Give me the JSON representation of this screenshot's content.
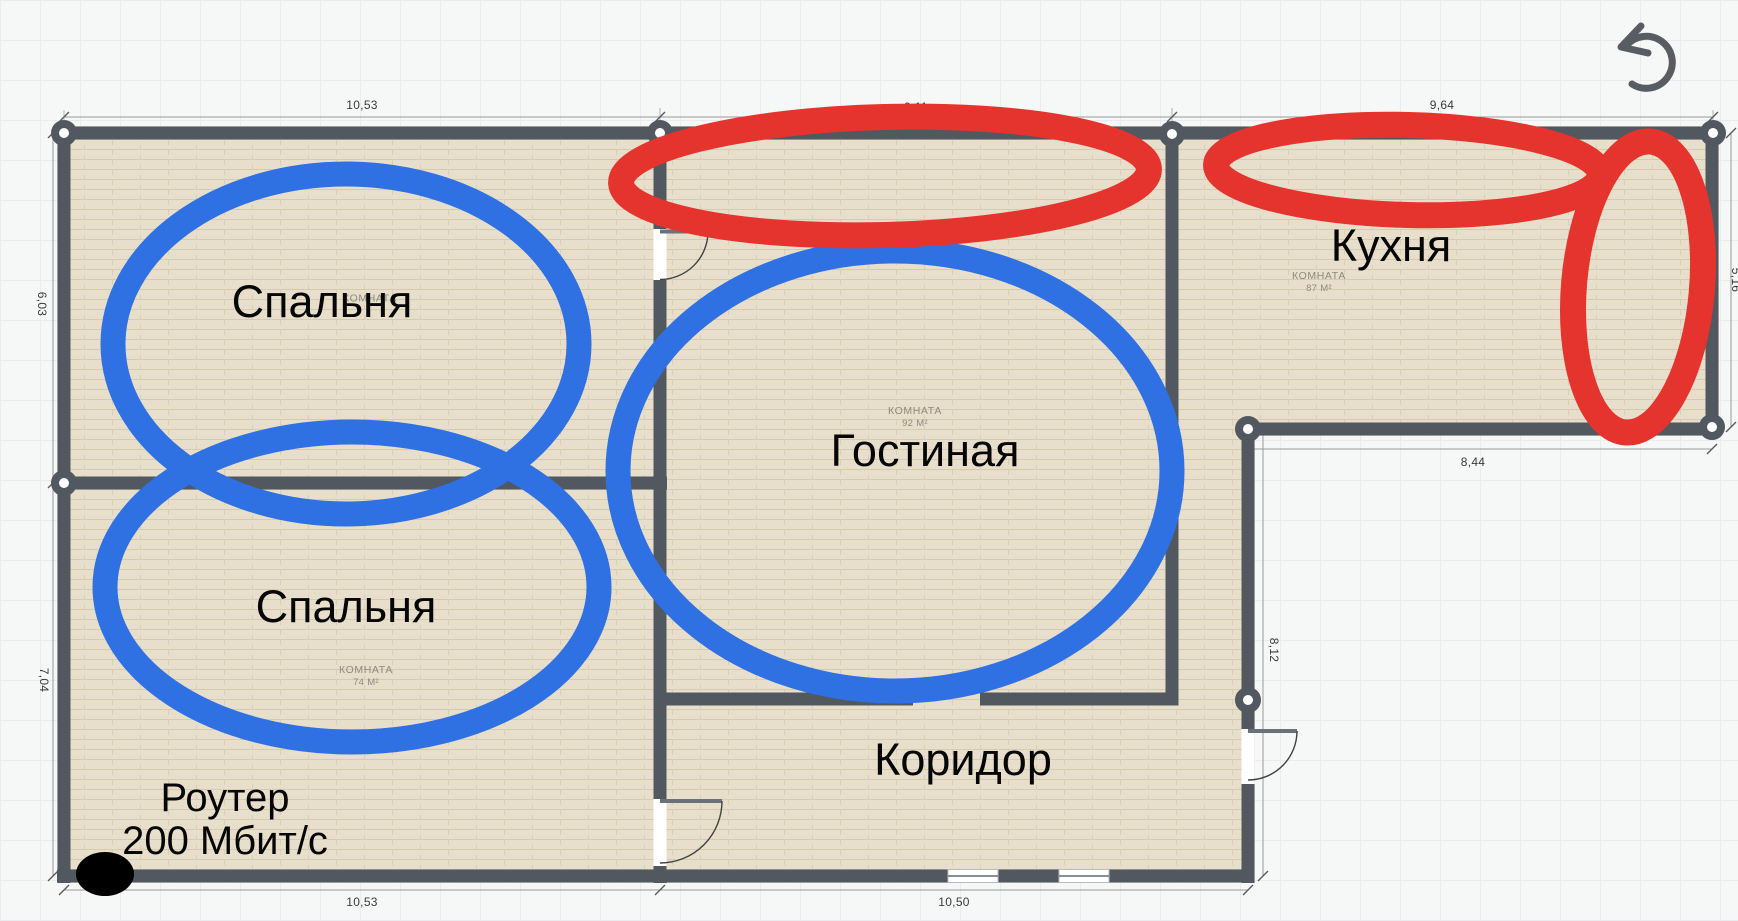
{
  "app": {
    "icons": {
      "undo": "↺"
    }
  },
  "rooms": {
    "bedroom_top": {
      "name": "Спальня",
      "tag": "КОМНАТА"
    },
    "bedroom_bottom": {
      "name": "Спальня",
      "tag": "КОМНАТА",
      "area": "74 М²"
    },
    "living_room": {
      "name": "Гостиная",
      "tag": "КОМНАТА",
      "area": "92 М²"
    },
    "kitchen": {
      "name": "Кухня",
      "tag": "КОМНАТА",
      "area": "87 М²"
    },
    "corridor": {
      "name": "Коридор"
    }
  },
  "annotation": {
    "router_line1": "Роутер",
    "router_line2": "200 Мбит/с"
  },
  "dimensions": {
    "top": [
      "10,53",
      "9,11",
      "9,64"
    ],
    "bottom": [
      "10,53",
      "10,50"
    ],
    "left": [
      "6,03",
      "7,04"
    ],
    "kitchen_bottom": "8,44",
    "hall_right": "8,12",
    "right_edge_clipped": "5,16"
  },
  "colors": {
    "annotation_blue": "#2f70e2",
    "annotation_red": "#e5342d",
    "wall": "#515860",
    "floor": "#e7dfcb"
  }
}
